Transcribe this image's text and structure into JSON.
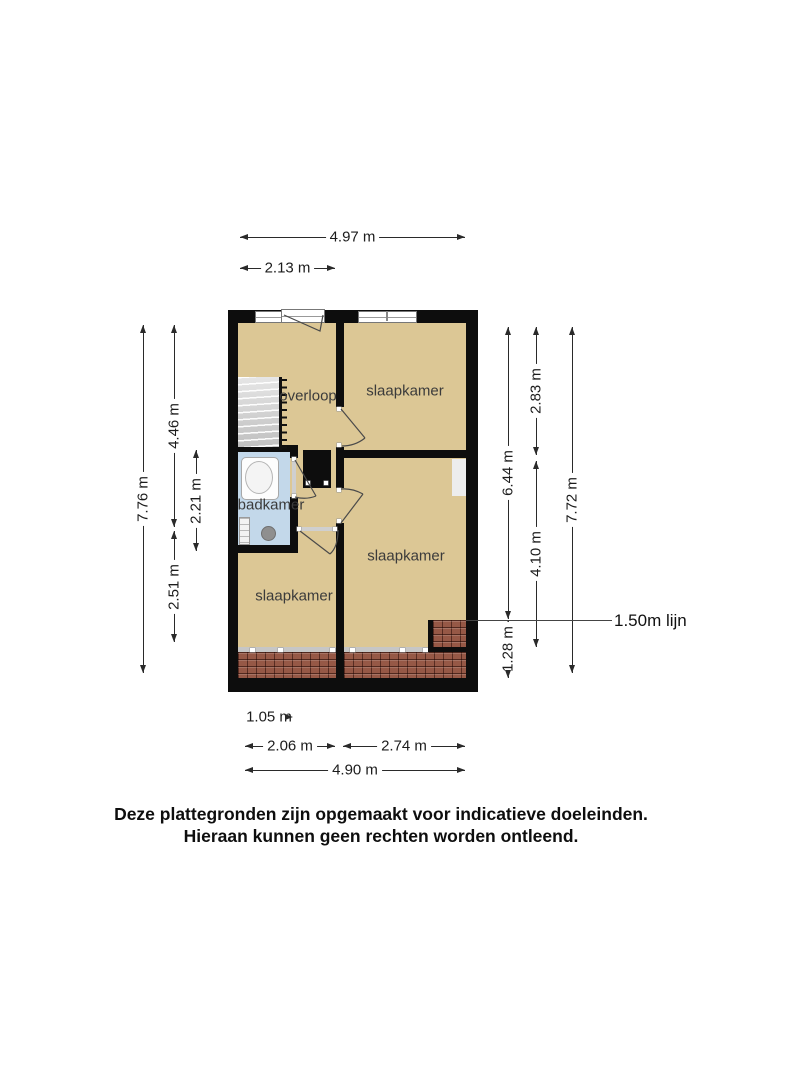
{
  "floorplan": {
    "rooms": {
      "overloop": "overloop",
      "bedroom_top": "slaapkamer",
      "bedroom_mid": "slaapkamer",
      "bedroom_bottom": "slaapkamer",
      "bathroom": "badkamer"
    },
    "annotation_line": "1.50m lijn",
    "dims": {
      "top_full": "4.97 m",
      "top_left": "2.13 m",
      "left_full": "7.76 m",
      "left_top": "4.46 m",
      "left_bath": "2.21 m",
      "left_bottom": "2.51 m",
      "right_to_line": "6.44 m",
      "right_top": "2.83 m",
      "right_mid": "4.10 m",
      "right_full": "7.72 m",
      "right_below_line": "1.28 m",
      "bottom_stairs": "1.05 m",
      "bottom_left": "2.06 m",
      "bottom_right": "2.74 m",
      "bottom_full": "4.90 m"
    },
    "colors": {
      "floor": "#dcc795",
      "bathroom_floor": "#c3d8ea",
      "wall": "#0d0d0d",
      "roof_tiles": "#965846",
      "stairs": "#d9d9d9",
      "knee_wall_line": "#c6c6c6"
    }
  },
  "footer": {
    "line1": "Deze plattegronden zijn opgemaakt voor indicatieve doeleinden.",
    "line2": "Hieraan kunnen geen rechten worden ontleend."
  }
}
